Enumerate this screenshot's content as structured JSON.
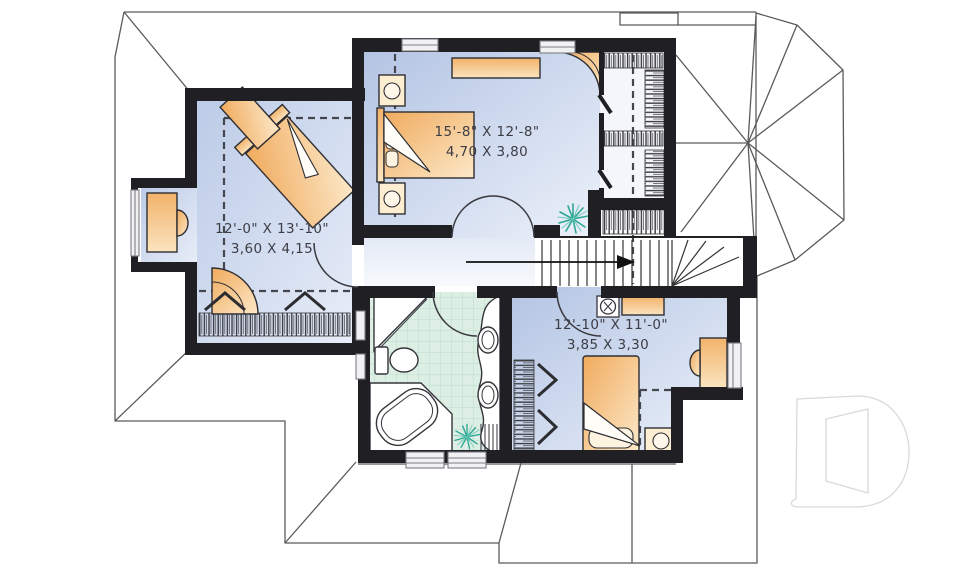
{
  "plan": {
    "kind": "second-floor-plan",
    "rooms": [
      {
        "id": "master-bedroom",
        "imperial": "15'-8\" X 12'-8\"",
        "metric": "4,70 X 3,80"
      },
      {
        "id": "bedroom-left",
        "imperial": "12'-0\" X 13'-10\"",
        "metric": "3,60 X 4,15"
      },
      {
        "id": "bedroom-right",
        "imperial": "12'-10\" X 11'-0\"",
        "metric": "3,85 X 3,30"
      }
    ],
    "icons": [
      "plant-icon",
      "ceiling-fan-icon",
      "stairs-arrow-icon",
      "double-door-icon",
      "door-swing-icon",
      "closet-hatch-icon",
      "window-icon",
      "drummond-d-watermark-icon"
    ],
    "colors": {
      "wall": "#1f1f24",
      "floor_blue_dark": "#b7c7e4",
      "floor_blue_light": "#eaeffa",
      "hall_blue": "#dfe7f3",
      "bath_green": "#ddefe5",
      "bath_grid": "#b9dcc9",
      "furniture_tan_dark": "#f0ac5f",
      "furniture_tan_light": "#fbe4bf",
      "roof_line": "#5a5a5a",
      "plant_teal": "#2ea795",
      "watermark_gray": "#d9d9d9",
      "text": "#3d3d46"
    }
  }
}
